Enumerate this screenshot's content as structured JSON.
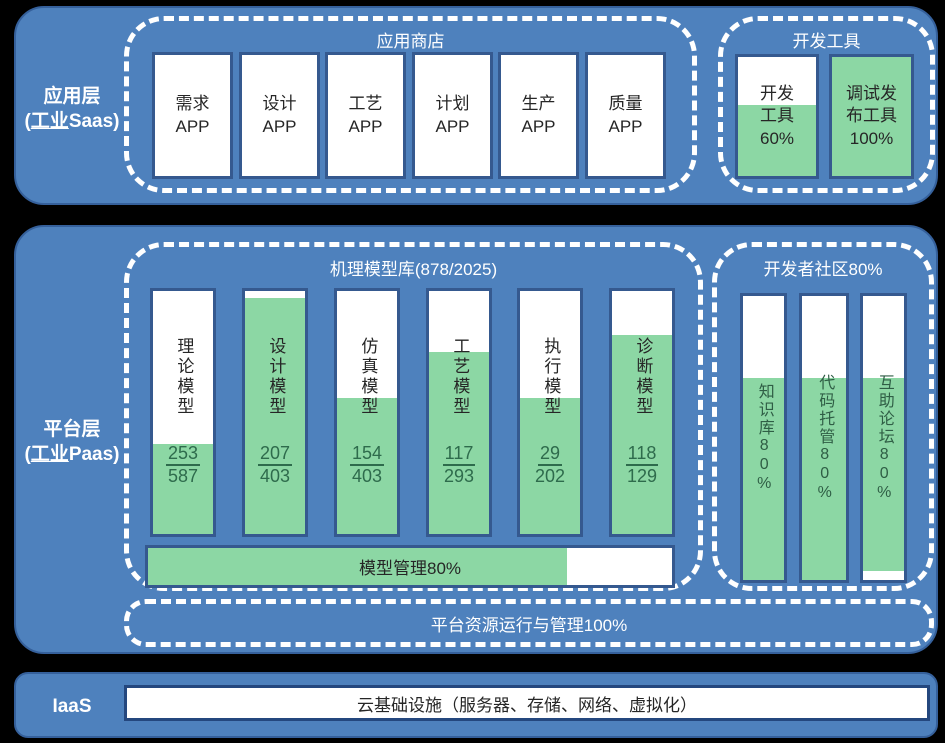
{
  "colors": {
    "background": "#000000",
    "layer_blue": "#4E81BD",
    "layer_border": "#35609B",
    "box_border": "#35598F",
    "gauge_green": "#8CD7A4",
    "green_text": "#2E6B4C",
    "dark_text": "#262626",
    "dashed_line": "#FFFFFF",
    "iaas_bar_border": "#24477E"
  },
  "app_layer": {
    "label_line1": "应用层",
    "label_paren_open": "(",
    "label_underlined": "工业",
    "label_suffix": "Saas)",
    "app_store": {
      "title": "应用商店",
      "apps": [
        {
          "line1": "需求",
          "line2": "APP"
        },
        {
          "line1": "设计",
          "line2": "APP"
        },
        {
          "line1": "工艺",
          "line2": "APP"
        },
        {
          "line1": "计划",
          "line2": "APP"
        },
        {
          "line1": "生产",
          "line2": "APP"
        },
        {
          "line1": "质量",
          "line2": "APP"
        }
      ]
    },
    "dev_tools": {
      "title": "开发工具",
      "tools": [
        {
          "line1": "开发",
          "line2": "工具",
          "line3": "60%",
          "fill_percent": 60
        },
        {
          "line1": "调试发",
          "line2": "布工具",
          "line3": "100%",
          "fill_percent": 100
        }
      ]
    }
  },
  "platform_layer": {
    "label_line1": "平台层",
    "label_paren_open": "(",
    "label_underlined": "工业",
    "label_suffix": "Paas)",
    "model_library": {
      "title": "机理模型库(878/2025)",
      "models": [
        {
          "name": "理论模型",
          "numerator": "253",
          "denominator": "587",
          "fill_percent": 37
        },
        {
          "name": "设计模型",
          "numerator": "207",
          "denominator": "403",
          "fill_percent": 97
        },
        {
          "name": "仿真模型",
          "numerator": "154",
          "denominator": "403",
          "fill_percent": 56
        },
        {
          "name": "工艺模型",
          "numerator": "117",
          "denominator": "293",
          "fill_percent": 75
        },
        {
          "name": "执行模型",
          "numerator": "29",
          "denominator": "202",
          "fill_percent": 56
        },
        {
          "name": "诊断模型",
          "numerator": "118",
          "denominator": "129",
          "fill_percent": 82
        }
      ],
      "model_mgmt": {
        "label": "模型管理80%",
        "fill_percent": 80
      }
    },
    "community": {
      "title": "开发者社区80%",
      "items": [
        {
          "name": "知识库80%",
          "fill_percent": 71,
          "bottom_gap_percent": 0
        },
        {
          "name": "代码托管80%",
          "fill_percent": 71,
          "bottom_gap_percent": 0
        },
        {
          "name": "互助论坛80%",
          "fill_percent": 68,
          "bottom_gap_percent": 3
        }
      ]
    },
    "resource_mgmt": {
      "label": "平台资源运行与管理100%"
    }
  },
  "iaas_layer": {
    "label": "IaaS",
    "bar_text": "云基础设施（服务器、存储、网络、虚拟化）"
  }
}
